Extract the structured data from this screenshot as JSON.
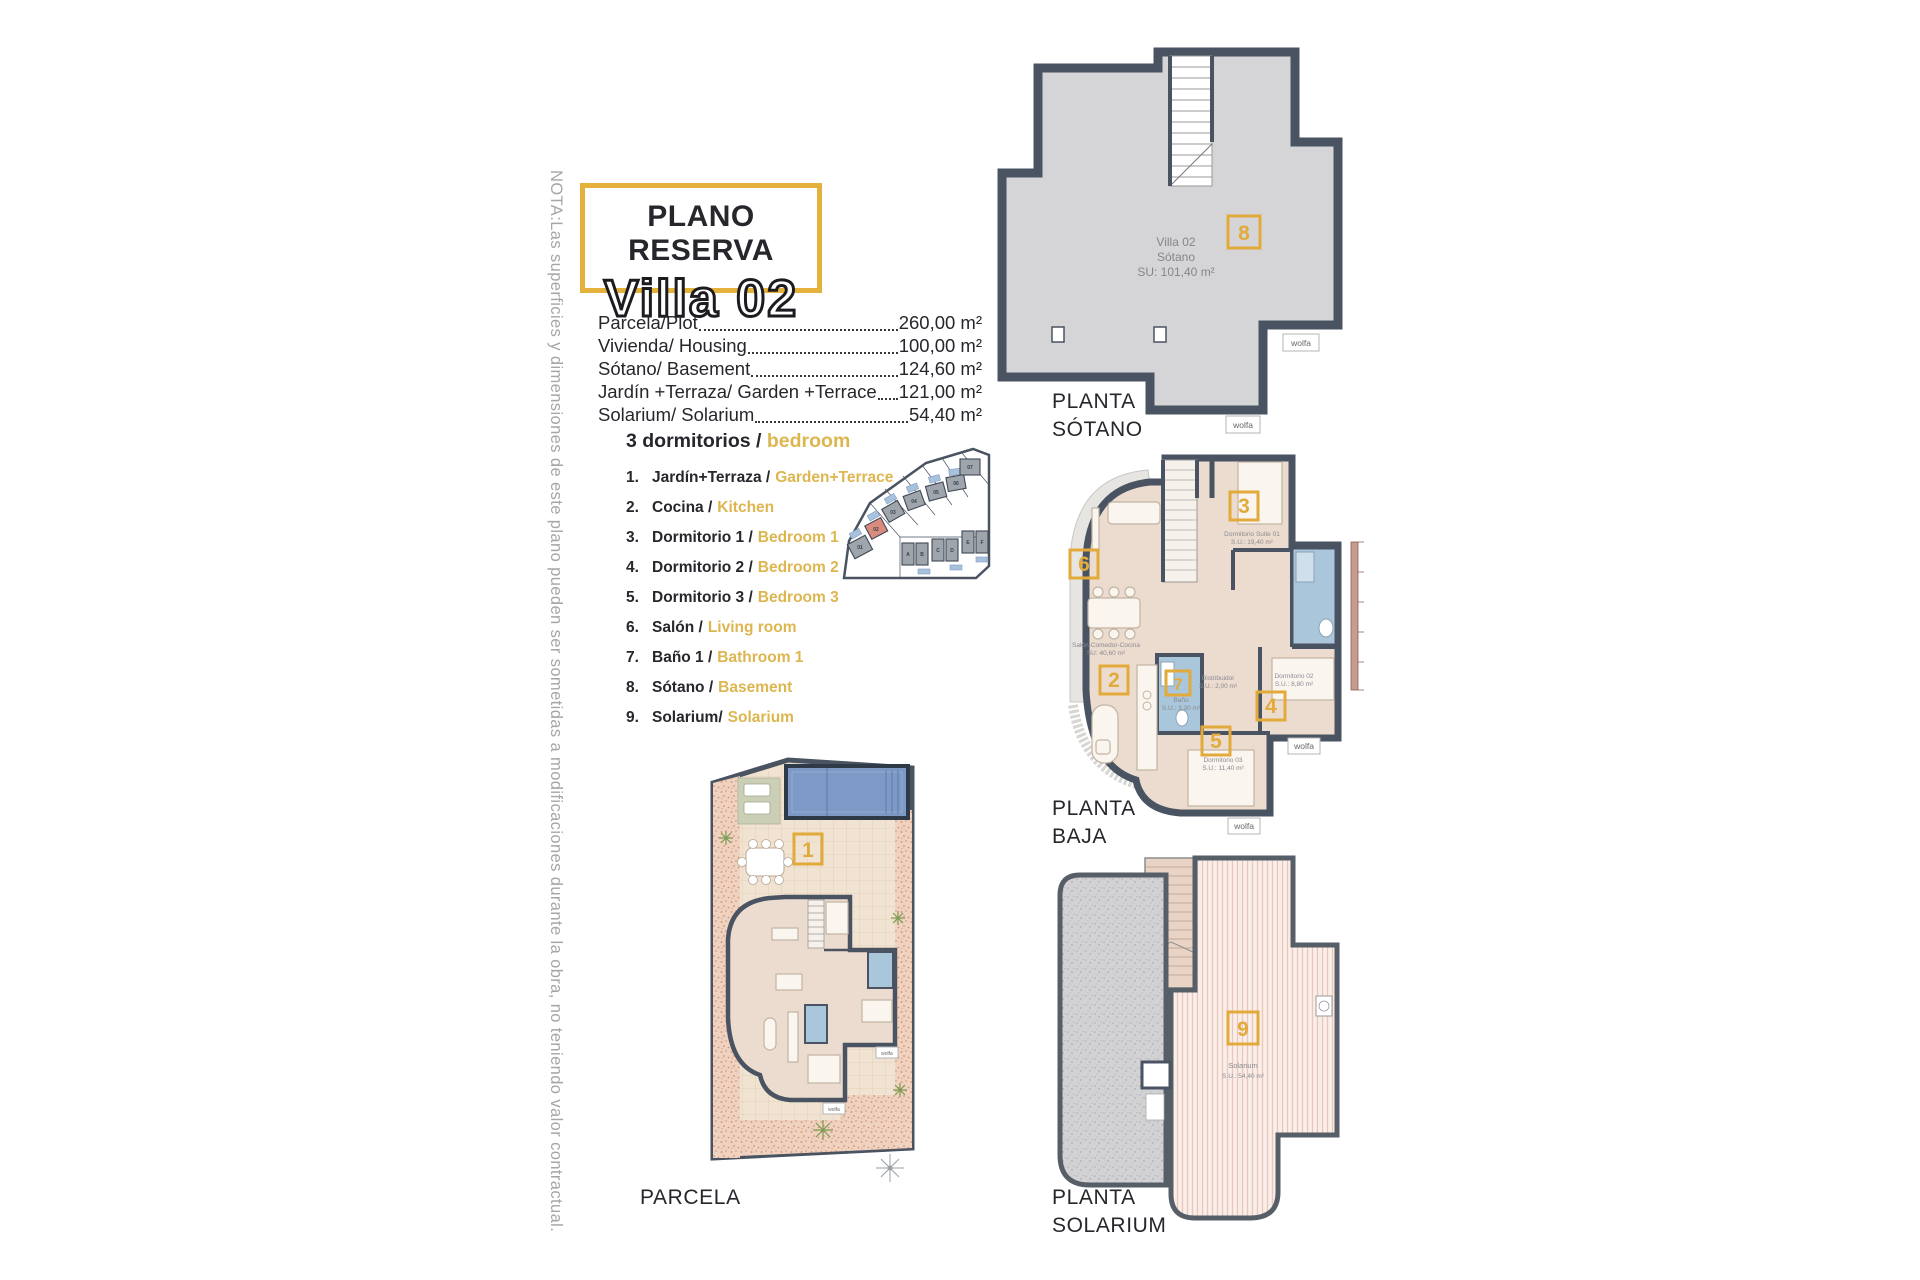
{
  "note_vertical": "NOTA:Las superficies y dimensiones de este plano pueden ser sometidas a modificaciones durante la obra, no teniendo valor contractual.",
  "title": {
    "line1": "PLANO RESERVA",
    "line2": "Villa 02"
  },
  "areas": [
    {
      "label": "Parcela/Plot",
      "value": "260,00 m²"
    },
    {
      "label": "Vivienda/ Housing",
      "value": "100,00 m²"
    },
    {
      "label": "Sótano/ Basement",
      "value": "124,60 m²"
    },
    {
      "label": "Jardín +Terraza/ Garden +Terrace",
      "value": "121,00 m²"
    },
    {
      "label": "Solarium/ Solarium",
      "value": "54,40 m²"
    }
  ],
  "legend": {
    "heading_es": "3 dormitorios /",
    "heading_en": "bedroom",
    "items": [
      {
        "num": "1.",
        "es": "Jardín+Terraza /",
        "en": "Garden+Terrace"
      },
      {
        "num": "2.",
        "es": "Cocina /",
        "en": "Kitchen"
      },
      {
        "num": "3.",
        "es": "Dormitorio 1 /",
        "en": "Bedroom 1"
      },
      {
        "num": "4.",
        "es": "Dormitorio 2 /",
        "en": "Bedroom 2"
      },
      {
        "num": "5.",
        "es": "Dormitorio 3 /",
        "en": "Bedroom 3"
      },
      {
        "num": "6.",
        "es": "Salón /",
        "en": "Living room"
      },
      {
        "num": "7.",
        "es": "Baño 1 /",
        "en": "Bathroom 1"
      },
      {
        "num": "8.",
        "es": "Sótano /",
        "en": "Basement"
      },
      {
        "num": "9.",
        "es": "Solarium/",
        "en": "Solarium"
      }
    ]
  },
  "floors": {
    "sotano": {
      "label1": "PLANTA",
      "label2": "SÓTANO",
      "badge": "8",
      "info1": "Villa 02",
      "info2": "Sótano",
      "info3": "SU: 101,40 m²"
    },
    "baja": {
      "label1": "PLANTA",
      "label2": "BAJA",
      "badge_living": "6",
      "badge_kitchen": "2",
      "badge_suite": "3",
      "badge_bath": "7",
      "badge_dorm2": "4",
      "badge_dorm3": "5",
      "rooms": {
        "suite_name": "Dormitorio Suite 01",
        "suite_area": "S.U.: 19,40 m²",
        "salon_name": "Salón-Comedor-Cocina",
        "salon_area": "SU: 40,60 m²",
        "dist_name": "Distribuidor",
        "dist_area": "S.U.: 2,00 m²",
        "bano_name": "Baño",
        "bano_area": "S.U.: 3,30 m²",
        "dorm2_name": "Dormitorio 02",
        "dorm2_area": "S.U.: 8,80 m²",
        "dorm3_name": "Dormitorio 03",
        "dorm3_area": "S.U.: 11,40 m²"
      }
    },
    "parcela": {
      "label": "PARCELA",
      "badge": "1"
    },
    "solarium": {
      "label1": "PLANTA",
      "label2": "SOLARIUM",
      "badge": "9",
      "info1": "Solarium",
      "info2": "S.U.: 54,40 m²"
    }
  },
  "logo": "wolfa",
  "site_map": {
    "villas": [
      "01",
      "02",
      "03",
      "04",
      "05",
      "06",
      "07"
    ],
    "units": [
      "A",
      "B",
      "C",
      "D",
      "E",
      "F"
    ]
  },
  "colors": {
    "accent": "#E2AA3A",
    "wall": "#4A5361",
    "legend_en": "#DDB650",
    "basement_fill": "#D5D5D7",
    "floor_fill": "#ECDCCF",
    "bath_fill": "#A9C6DA",
    "pool_fill": "#7D99C6",
    "highlight_plot": "#D98C7E"
  }
}
